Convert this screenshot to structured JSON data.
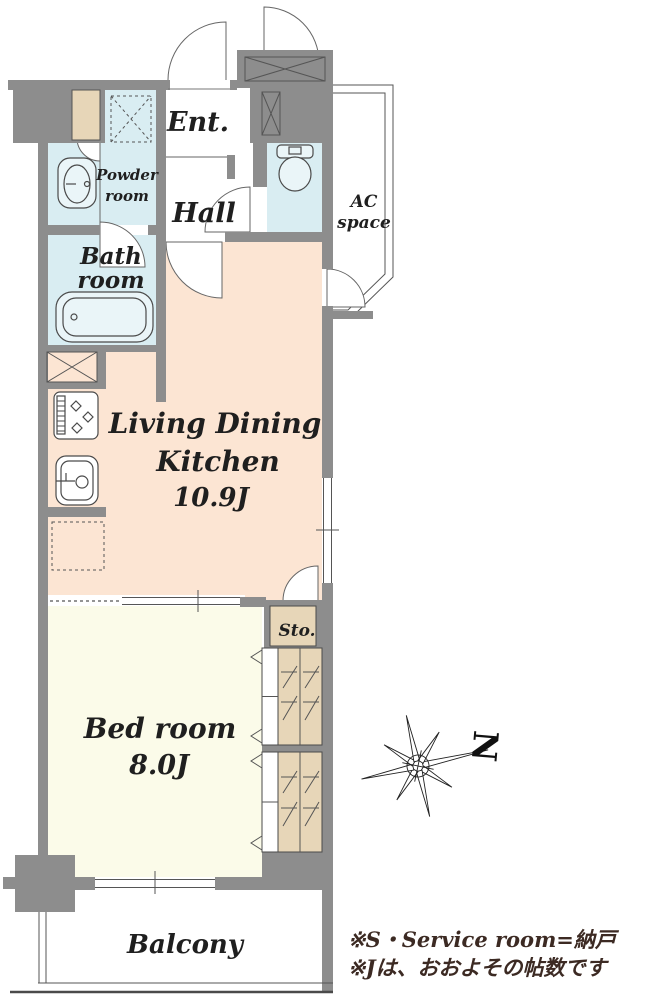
{
  "plan_title": "apartment-floor-plan",
  "colors": {
    "wall": "#8d8d8d",
    "ldk_floor": "#fce5d3",
    "bedroom_floor": "#fbfbe9",
    "wet_area_floor": "#d9edf2",
    "closet_fill": "#e7d6b8",
    "fixture_fill": "#eaf5f8",
    "label_text": "#1f1f1f",
    "note_text": "#3c2a23"
  },
  "rooms": {
    "entrance": {
      "label": "Ent."
    },
    "hall": {
      "label": "Hall"
    },
    "powder_room": {
      "label": [
        "Powder",
        "room"
      ]
    },
    "bath_room": {
      "label": [
        "Bath",
        "room"
      ]
    },
    "toilet": {
      "label": ""
    },
    "ac_space": {
      "label": [
        "AC",
        "space"
      ]
    },
    "ldk": {
      "label": [
        "Living Dining",
        "Kitchen",
        "10.9J"
      ],
      "size_tatami": "10.9J"
    },
    "storage": {
      "label": "Sto."
    },
    "bedroom": {
      "label": [
        "Bed room",
        "8.0J"
      ],
      "size_tatami": "8.0J"
    },
    "balcony": {
      "label": "Balcony"
    }
  },
  "compass": {
    "label": "N"
  },
  "notes": {
    "line1": "※S・Service room=納戸",
    "line2": "※Jは、おおよその帖数です"
  }
}
